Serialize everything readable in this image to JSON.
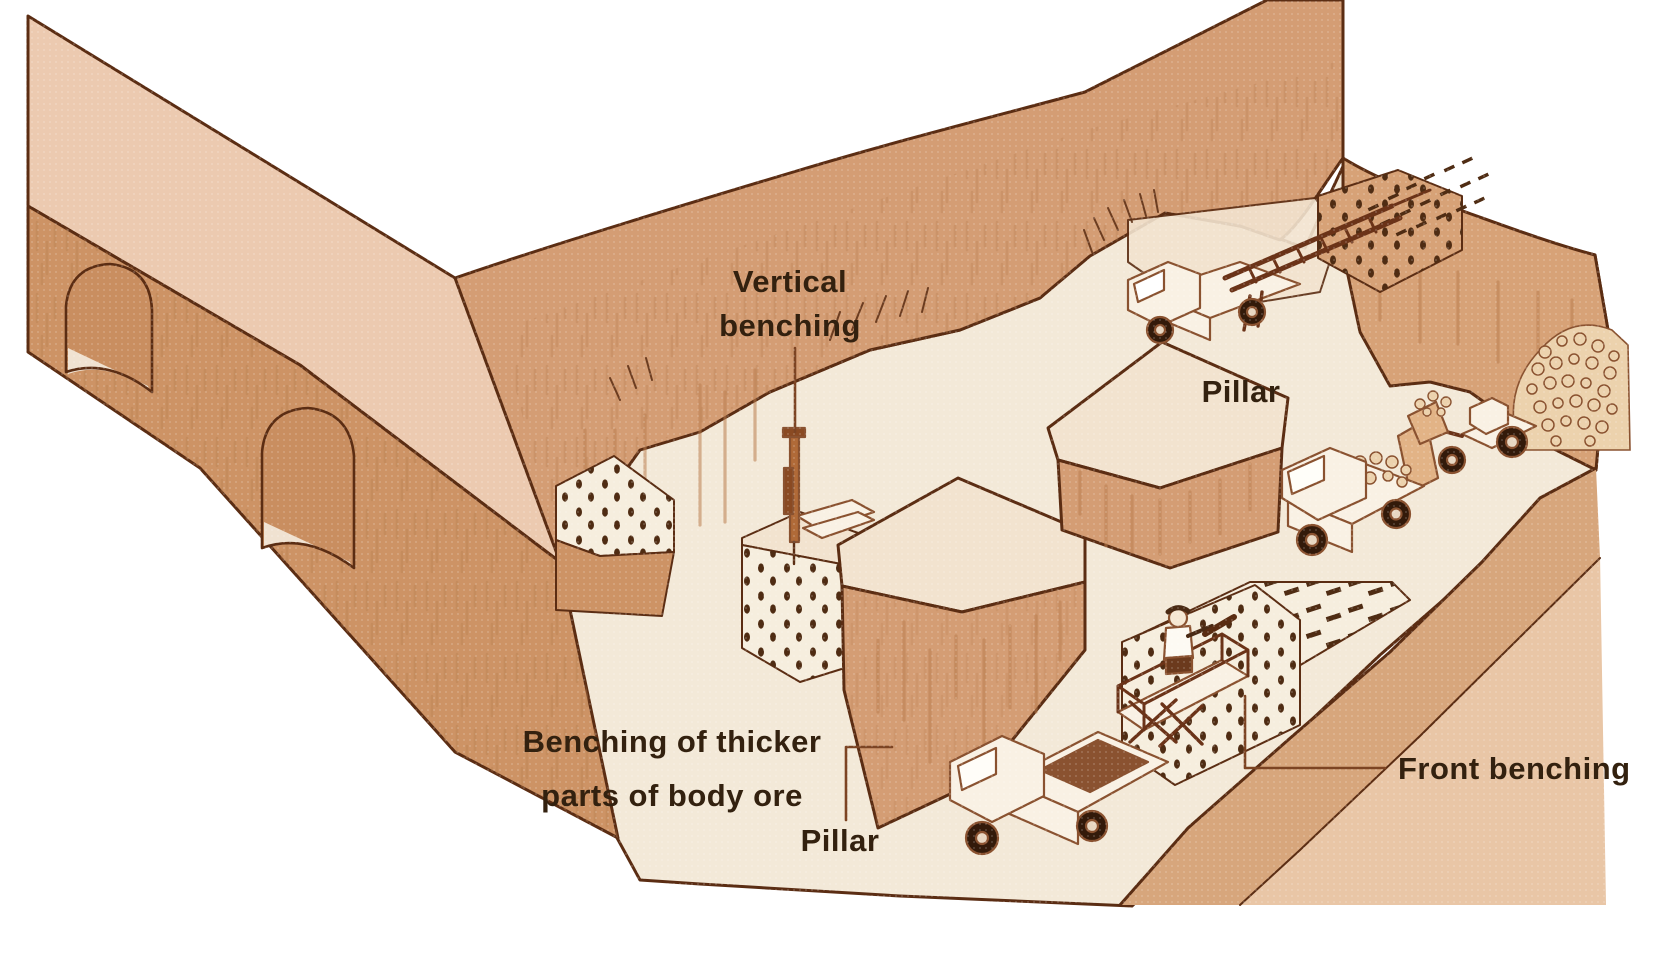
{
  "labels": {
    "vertical_benching_line1": "Vertical",
    "vertical_benching_line2": "benching",
    "pillar_top": "Pillar",
    "benching_line1": "Benching of thicker",
    "benching_line2": "parts of body ore",
    "pillar_bottom": "Pillar",
    "front_benching": "Front benching"
  },
  "parts": [
    "left-gallery-wall-with-arched-openings",
    "back-wall",
    "vertical-benching-drill-rig",
    "drilled-bench-top",
    "vertical-benching-face",
    "center-pillar",
    "right-pillar",
    "front-benching-face",
    "bench-floor-blastholes",
    "scissor-lift-truck",
    "miner-with-rock-drill",
    "drill-jumbo-truck",
    "top-bench-drilling-face",
    "blast-debris",
    "haul-truck",
    "front-end-loader",
    "muck-pile",
    "access-ramp"
  ],
  "palette": {
    "page_bg": "#ffffff",
    "outline": "#5b2d13",
    "rock_light": "#eccab0",
    "rock_medium": "#d49d74",
    "rock_medium_dark": "#cd9365",
    "rock_wall_right": "#d7a277",
    "top_pale": "#f2e3cf",
    "floor_cream": "#f3e9d8",
    "arch_inner": "#c98e60",
    "arch_floor": "#f0e2d1",
    "ramp_tan": "#d7a67c",
    "ramp_light": "#e9c6a6",
    "bench_face": "#f6eede",
    "hole_dot": "#4f2c13",
    "label_text": "#33210f",
    "leader": "#7c4423",
    "vehicle_body": "#f9f1e4",
    "vehicle_dark": "#331a0a",
    "ore_fill": "#ecd2ad",
    "ore_line": "#8a5230",
    "streak": "#b97e51"
  }
}
